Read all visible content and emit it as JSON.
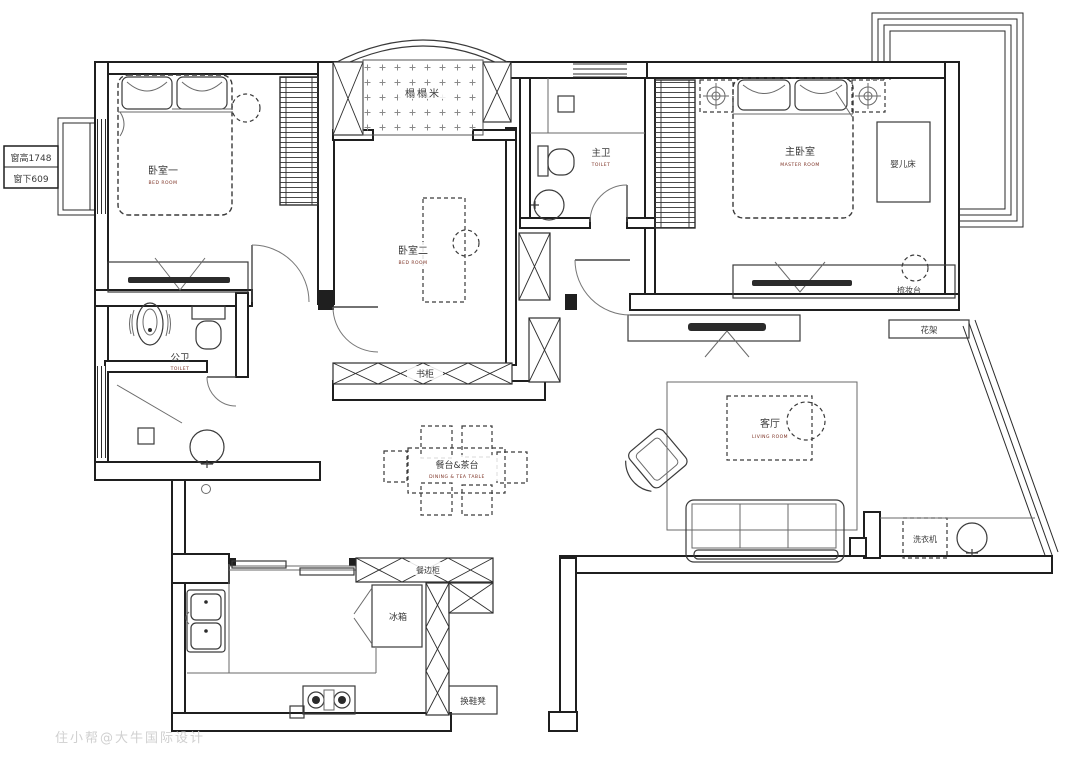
{
  "plan": {
    "labels": {
      "bedroom1": "卧室一",
      "bedroom1_sub": "BED ROOM",
      "tatami": "榻榻米",
      "bedroom2": "卧室二",
      "bedroom2_sub": "BED ROOM",
      "master_bath": "主卫",
      "master_bath_sub": "TOILET",
      "master_bedroom": "主卧室",
      "master_bedroom_sub": "MASTER ROOM",
      "baby_crib": "婴儿床",
      "dressing_table": "梳妆台",
      "flower_rack": "花架",
      "public_bath": "公卫",
      "public_bath_sub": "TOILET",
      "bookcase": "书柜",
      "dining_table": "餐台&茶台",
      "dining_table_sub": "DINING & TEA TABLE",
      "living_room": "客厅",
      "living_room_sub": "LIVING ROOM",
      "washing_machine": "洗衣机",
      "fridge": "冰箱",
      "sideboard": "餐边柜",
      "shoe_bench": "换鞋凳"
    },
    "annotations": {
      "window_note_line1": "窗高1748",
      "window_note_line2": "窗下609",
      "watermark": "住小帮@大牛国际设计"
    },
    "colors": {
      "line": "#1f1f1f",
      "label": "#3a3a3a",
      "sublabel": "#7a2e20",
      "watermark": "#d0d0d0"
    }
  }
}
